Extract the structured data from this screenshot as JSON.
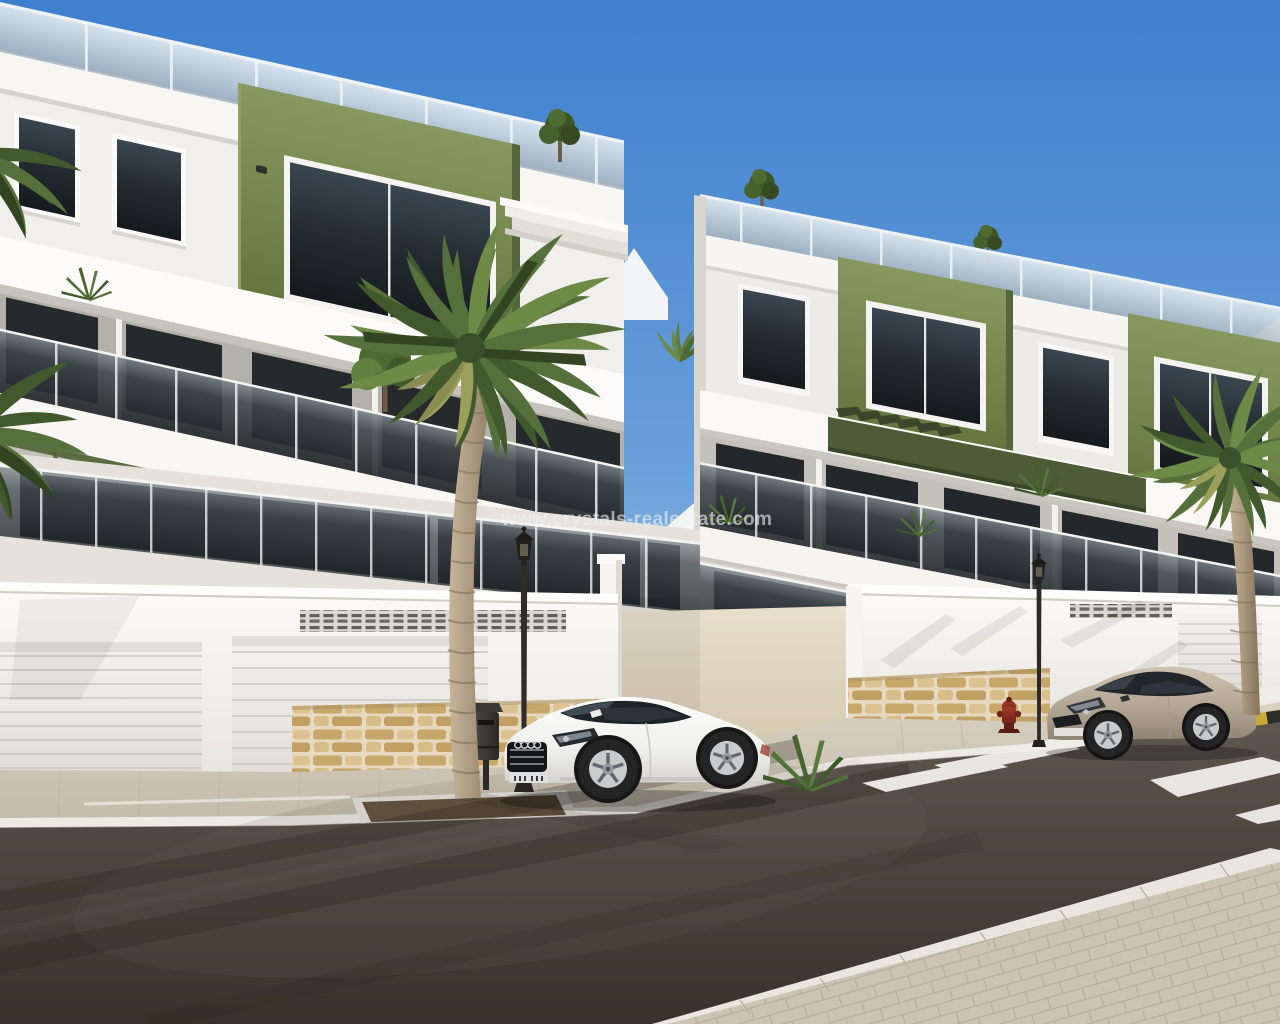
{
  "scene": {
    "type": "architectural-render-photo",
    "description": "Street-level 3D render of a new-build white and olive-green apartment complex with glass balconies, roof terraces, garage level with stone base, palm trees, two parked coupes and a zebra crossing under a clear blue sky",
    "watermark": {
      "text": "www.crystals-realestate.com"
    },
    "objects": [
      "apartment-building-left",
      "apartment-building-right",
      "roof-terrace-glass-railing",
      "green-accent-block",
      "balcony-glass-railing",
      "pergola-slats",
      "gable-roof-house",
      "garage-door",
      "ventilation-grille",
      "stone-base-wall",
      "paved-sidewalk",
      "tree-planter",
      "street-lamp",
      "litter-bin",
      "fire-hydrant",
      "yellow-black-curb",
      "white-coupe-car",
      "beige-coupe-car",
      "zebra-crossing",
      "asphalt-road",
      "foreground-palm-tree",
      "right-palm-tree",
      "rooftop-trees",
      "terrace-plants"
    ]
  },
  "palette": {
    "sky_top": "#3f7fce",
    "sky_horizon": "#d4e6f4",
    "facade_white": "#f6f5f2",
    "accent_green": "#7a8b52",
    "pergola_olive": "#4c5a36",
    "glass_dark": "#2b3034",
    "stone_tan": "#d3b87f",
    "asphalt": "#4a443d",
    "sidewalk": "#cbc4b5",
    "crosswalk_white": "#efeee9",
    "car_white": "#f4f4f2",
    "car_beige": "#b0a292",
    "hydrant_red": "#8c2f23",
    "lamp_black": "#232220",
    "watermark_color": "#eef1f4"
  }
}
